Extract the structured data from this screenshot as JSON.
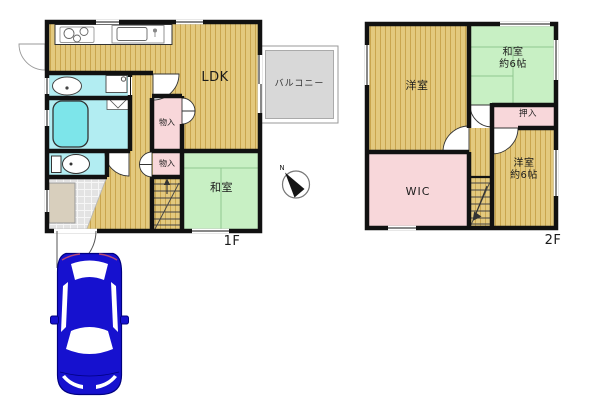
{
  "floor1": {
    "label": "1F",
    "balcony": "バルコニー",
    "rooms": {
      "ldk": "LDK",
      "storage_upper": "物入",
      "storage_lower": "物入",
      "japanese_room": "和室"
    }
  },
  "floor2": {
    "label": "2F",
    "rooms": {
      "western_room": "洋室",
      "japanese_room": "和室\n約6帖",
      "closet": "押入",
      "wic": "WIC",
      "western_room_6": "洋室\n約6帖"
    }
  },
  "compass": {
    "north": "N"
  },
  "colors": {
    "wood_base": "#E3C97E",
    "wood_stripe": "#C9A54E",
    "tatami": "#C8F0C4",
    "tatami_line": "#8FC78F",
    "closet_pink": "#F8D7DA",
    "water_blue": "#B2EDF2",
    "bathtub": "#7DE5EA",
    "balcony_gray": "#D8D8D8",
    "genkan_tile": "#E3E3E3",
    "cabinet_beige": "#D8CFBD",
    "wall": "#111111",
    "car_blue": "#1611CF",
    "car_outline": "#000080"
  }
}
